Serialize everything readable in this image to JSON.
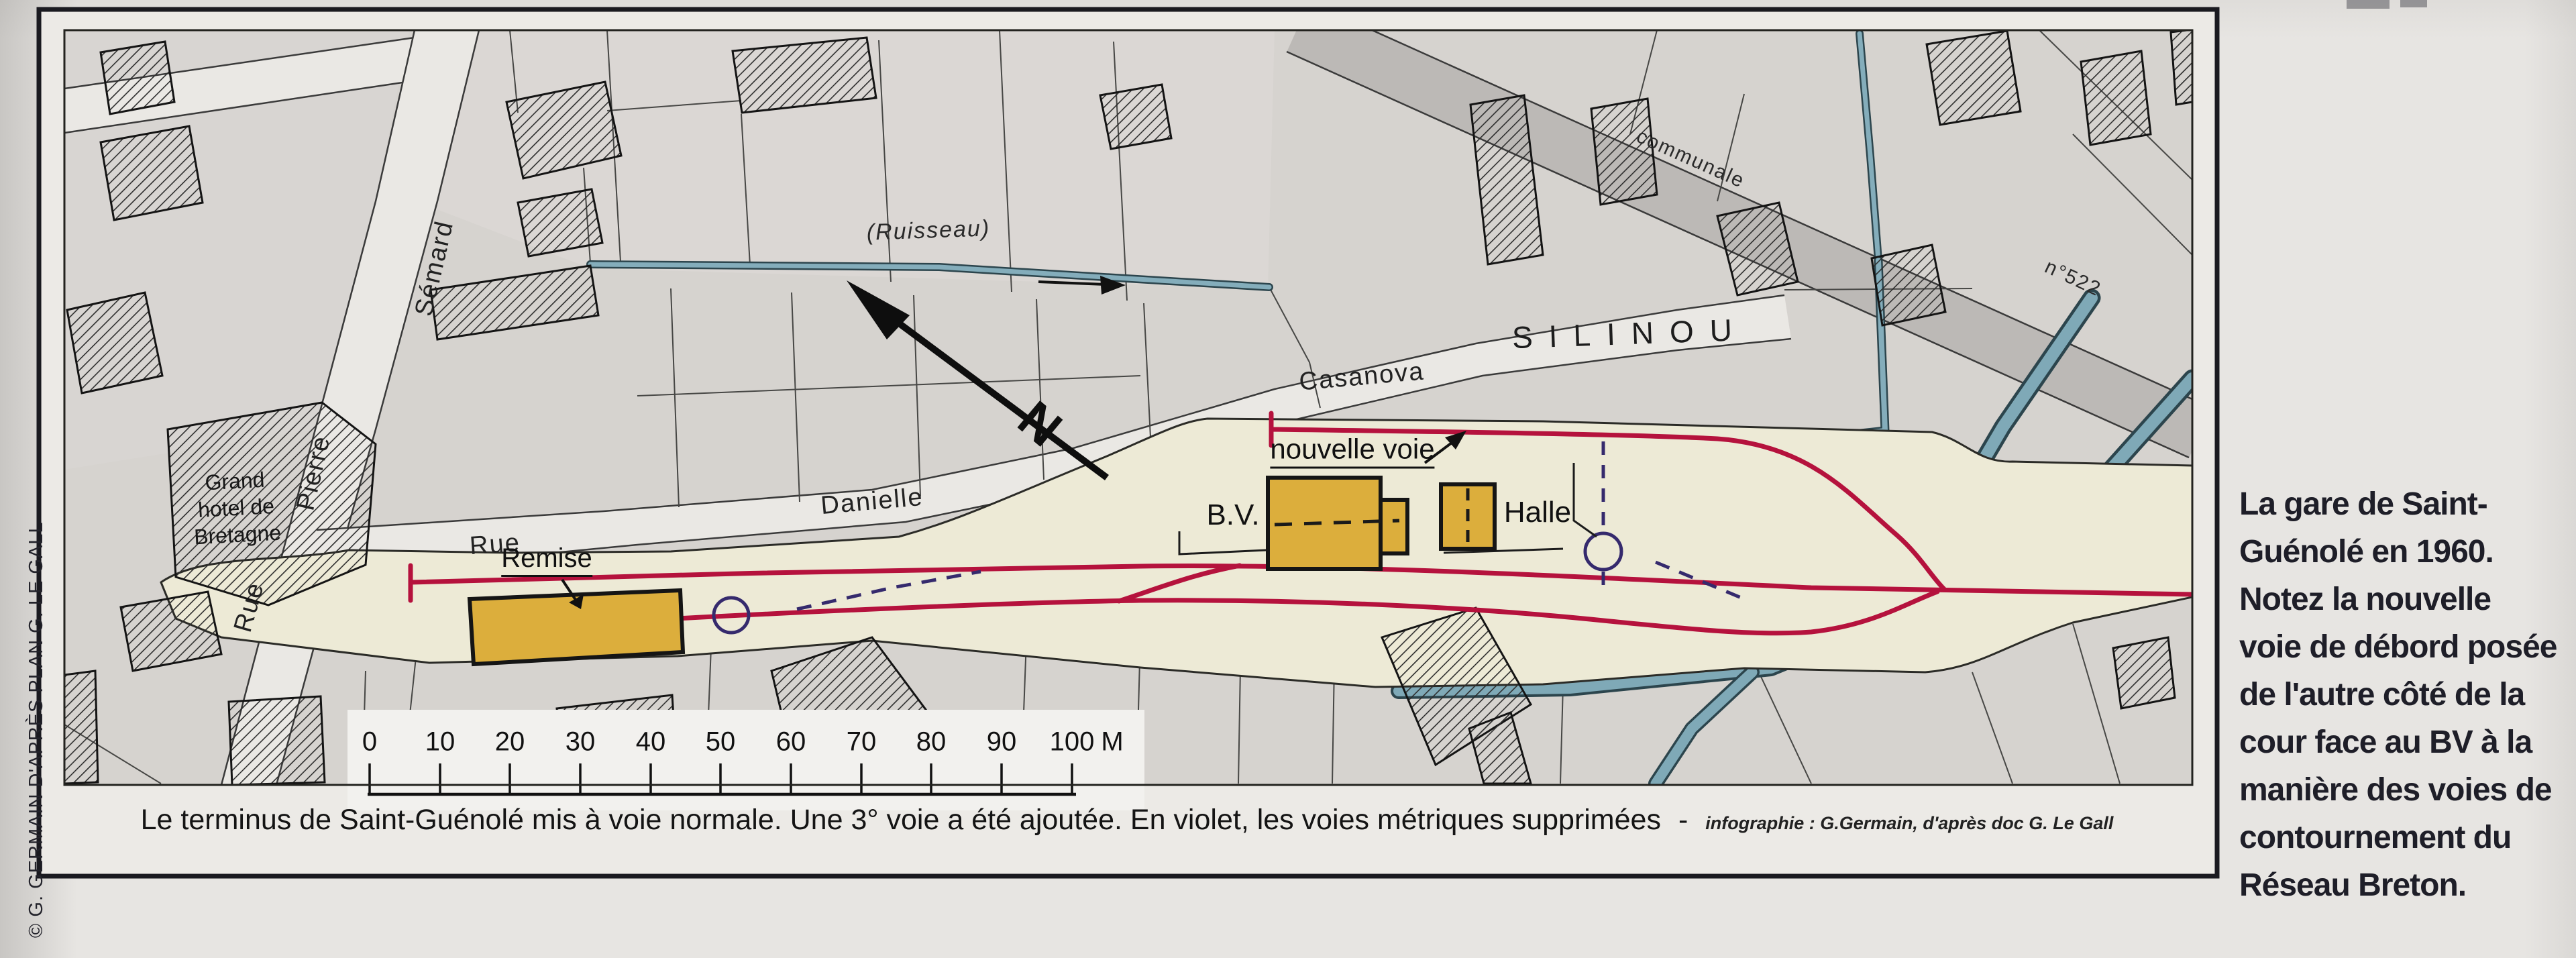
{
  "page": {
    "credit_vertical": "© G. GERMAIN D'APRÈS PLAN G. LE GALL"
  },
  "map": {
    "street_labels": {
      "rue_ps": "Rue",
      "pierre": "Pierre",
      "semard": "Sémard",
      "rue_dc": "Rue",
      "danielle": "Danielle",
      "casanova": "Casanova",
      "communale": "communale",
      "road_number": "n°522"
    },
    "area_labels": {
      "silinou": "SILINOU",
      "ruisseau": "(Ruisseau)",
      "hotel_line1": "Grand",
      "hotel_line2": "hotel de",
      "hotel_line3": "Bretagne"
    },
    "feature_labels": {
      "remise": "Remise",
      "bv": "B.V.",
      "halle": "Halle",
      "nouvelle_voie": "nouvelle voie",
      "north": "N"
    },
    "scale_bar": {
      "ticks": [
        "0",
        "10",
        "20",
        "30",
        "40",
        "50",
        "60",
        "70",
        "80",
        "90",
        "100"
      ],
      "unit": "M"
    }
  },
  "caption": {
    "text": "Le terminus de Saint-Guénolé mis à voie normale. Une 3° voie a été ajoutée. En violet, les voies métriques supprimées",
    "dash": "-",
    "credit": "infographie : G.Germain, d'après doc G. Le Gall"
  },
  "sidebar": {
    "lines": [
      "La gare de Saint-",
      "Guénolé en 1960.",
      "Notez la nouvelle",
      "voie de débord posée",
      "de l'autre côté de la",
      "cour face au BV à la",
      "manière des voies de",
      "contournement du",
      "Réseau Breton."
    ]
  },
  "colors": {
    "track_red": "#b5123d",
    "metric_purple": "#352a6d",
    "water_blue": "#84adbb",
    "water_edge": "#2c454d",
    "building_yellow": "#dcae3c",
    "station_cream": "#edead6",
    "map_gray": "#d6d3cf",
    "road_gray": "#bcb9b6"
  }
}
